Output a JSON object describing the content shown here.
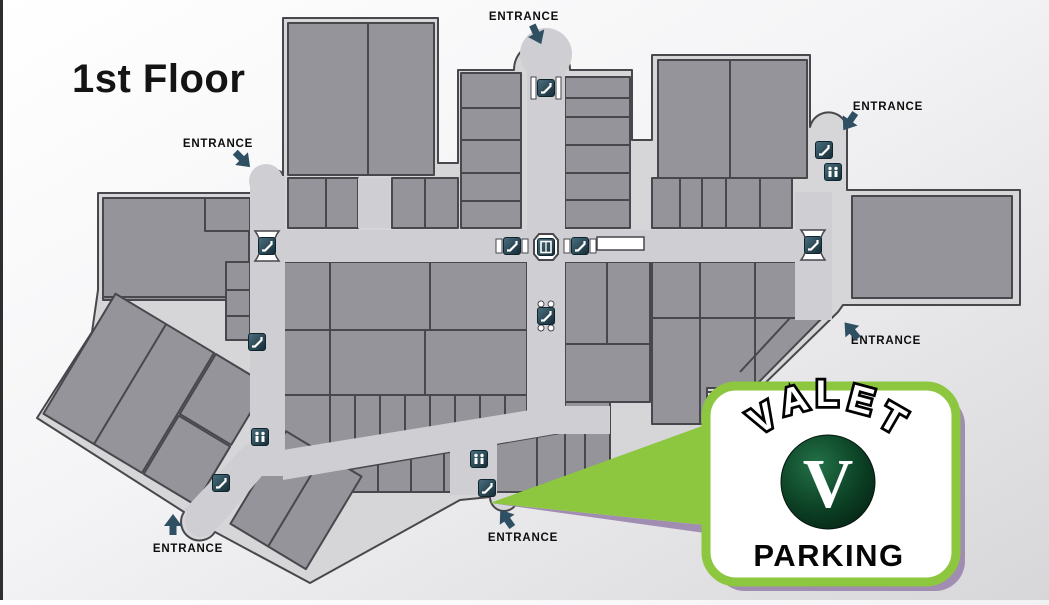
{
  "title": "1st Floor",
  "map": {
    "background": "#d6d6d9",
    "corridor": "#cfcfd3",
    "store_fill": "#94949a",
    "outline": "#47474c",
    "icon_bg_dark": "#16303c",
    "icon_bg_light": "#4b7080",
    "arrow_color": "#2f5062"
  },
  "entrances": [
    {
      "label": "ENTRANCE",
      "lx": 218,
      "ly": 147,
      "ax": 243,
      "ay": 160,
      "rot": 135
    },
    {
      "label": "ENTRANCE",
      "lx": 524,
      "ly": 20,
      "ax": 537,
      "ay": 35,
      "rot": 155
    },
    {
      "label": "ENTRANCE",
      "lx": 888,
      "ly": 110,
      "ax": 849,
      "ay": 122,
      "rot": 215
    },
    {
      "label": "ENTRANCE",
      "lx": 886,
      "ly": 344,
      "ax": 851,
      "ay": 330,
      "rot": 320
    },
    {
      "label": "ENTRANCE",
      "lx": 523,
      "ly": 541,
      "ax": 506,
      "ay": 518,
      "rot": 325
    },
    {
      "label": "ENTRANCE",
      "lx": 188,
      "ly": 552,
      "ax": 173,
      "ay": 524,
      "rot": 0
    }
  ],
  "icons": [
    {
      "type": "escalator",
      "deco": "spool",
      "x": 267,
      "y": 246
    },
    {
      "type": "escalator",
      "deco": "none",
      "x": 257,
      "y": 342
    },
    {
      "type": "escalator",
      "deco": "flank",
      "x": 512,
      "y": 246
    },
    {
      "type": "elevator",
      "deco": "octagon",
      "x": 546,
      "y": 247
    },
    {
      "type": "escalator",
      "deco": "flank",
      "x": 580,
      "y": 246
    },
    {
      "type": "escalator",
      "deco": "dots",
      "x": 546,
      "y": 316
    },
    {
      "type": "escalator",
      "deco": "spool",
      "x": 813,
      "y": 245
    },
    {
      "type": "escalator",
      "deco": "pillars",
      "x": 546,
      "y": 88
    },
    {
      "type": "restroom",
      "deco": "none",
      "x": 260,
      "y": 437
    },
    {
      "type": "escalator",
      "deco": "none",
      "x": 221,
      "y": 483
    },
    {
      "type": "restroom",
      "deco": "none",
      "x": 479,
      "y": 459
    },
    {
      "type": "escalator",
      "deco": "none",
      "x": 487,
      "y": 488
    },
    {
      "type": "escalator",
      "deco": "none",
      "x": 824,
      "y": 150
    },
    {
      "type": "restroom",
      "deco": "none",
      "x": 833,
      "y": 172
    }
  ],
  "valet": {
    "arc_label": "VALET",
    "letters": [
      {
        "ch": "V",
        "x": 769,
        "y": 429,
        "rot": -30
      },
      {
        "ch": "A",
        "x": 797,
        "y": 412,
        "rot": -15
      },
      {
        "ch": "L",
        "x": 827,
        "y": 406,
        "rot": 0
      },
      {
        "ch": "E",
        "x": 858,
        "y": 412,
        "rot": 15
      },
      {
        "ch": "T",
        "x": 886,
        "y": 429,
        "rot": 30
      }
    ],
    "monogram": "V",
    "label": "PARKING",
    "accent_green": "#8dc63f",
    "shadow_purple": "#a18cb2",
    "circle_green_dark": "#052214"
  }
}
